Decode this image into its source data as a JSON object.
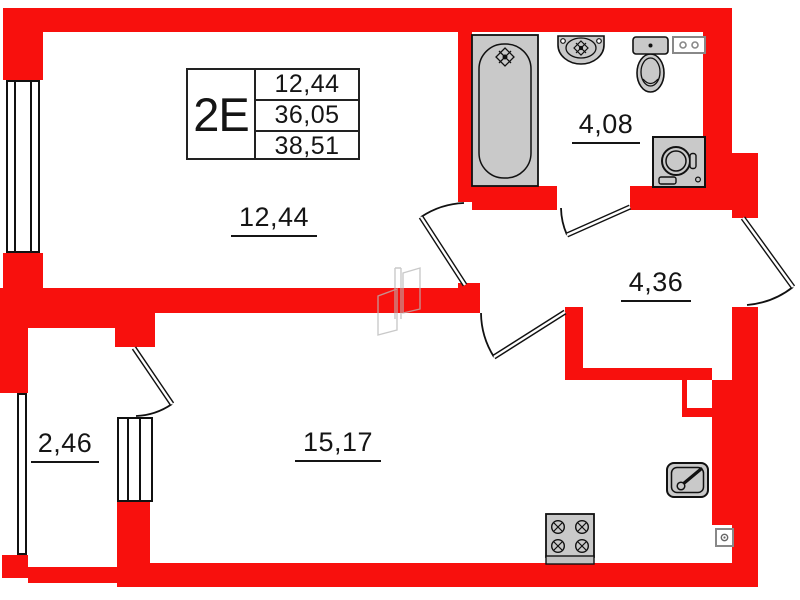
{
  "plan": {
    "title_block": {
      "unit_type": "2E",
      "areas": [
        "12,44",
        "36,05",
        "38,51"
      ]
    },
    "rooms": [
      {
        "name": "living-room",
        "area": "12,44"
      },
      {
        "name": "bathroom",
        "area": "4,08"
      },
      {
        "name": "hallway",
        "area": "4,36"
      },
      {
        "name": "kitchen-living-room",
        "area": "15,17"
      },
      {
        "name": "balcony",
        "area": "2,46"
      }
    ],
    "fixtures": [
      "bathtub",
      "wash-basin",
      "toilet",
      "electrical-panel",
      "washing-machine",
      "kitchen-sink",
      "stove",
      "socket"
    ],
    "colors": {
      "wall": "#f8100d",
      "fixture_fill": "#c9c9c9",
      "line": "#111111",
      "background": "#ffffff"
    }
  }
}
